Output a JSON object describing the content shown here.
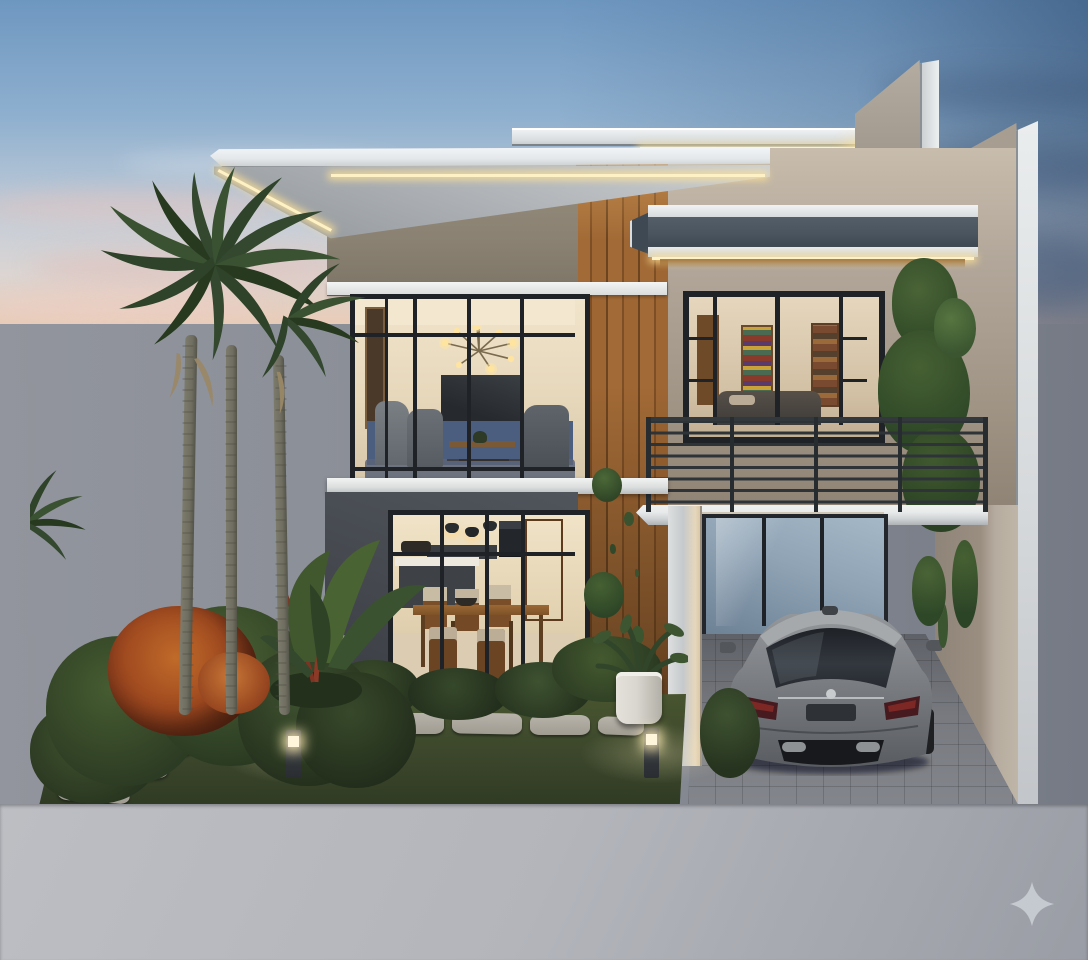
{
  "scene": {
    "description": "Dusk 3D architectural rendering of a modern two-storey house with white cantilevered LED-lit flat roofs, vertical wood slat accents, floor-to-ceiling black-framed glazing, a balcony with black bar railing, a carport with a parked grey sedan, palm trees and a landscaped front garden",
    "time_of_day": "dusk",
    "building": {
      "storeys": 2,
      "features": [
        "flat-roof-led-strip",
        "upper-roof",
        "stepped-parapet-fins",
        "wood-slat-feature-wall",
        "balcony-canopy",
        "balcony-bar-railing",
        "white-floor-slab",
        "charcoal-ground-wall",
        "carport-column"
      ],
      "living_room": [
        "sputnik-chandelier",
        "wall-tv",
        "navy-accent-wall",
        "armchairs",
        "wood-coffee-table",
        "area-rug"
      ],
      "bedroom": [
        "french-doors",
        "bookshelf",
        "bed",
        "wardrobe"
      ],
      "kitchen_dining": [
        "pendant-lights",
        "wall-oven",
        "kitchen-island",
        "wood-door",
        "wood-dining-table",
        "dining-chairs",
        "fruit-bowl"
      ]
    },
    "carport": [
      "grey-sedan-rear-view",
      "paver-floor",
      "reflective-back-window",
      "hanging-vines"
    ],
    "garden": [
      "palm-trees-3",
      "croton-red-shrub",
      "banana-plant",
      "green-bushes",
      "lawn",
      "stepping-stone-path",
      "stone-stair",
      "bollard-path-lights-2",
      "white-planter-pot",
      "climbing-vines"
    ],
    "background": [
      "sunset-sky",
      "pink-horizon-clouds",
      "dark-blue-cloud-bands",
      "grey-boundary-wall",
      "grey-concrete-foreground"
    ],
    "watermark": {
      "icon": "sparkle-icon"
    }
  },
  "colors": {
    "sky-top": "#6E97C0",
    "sky-mid": "#8FB0CF",
    "sky-low": "#C6CED8",
    "sunset-pink": "#E8CDBA",
    "bg-wall": "#8A8E97",
    "bg-wall-dark": "#757A85",
    "fg-ground": "#B3B5BB",
    "fg-ground-dark": "#9A9DA5",
    "roof-white": "#EDEFF1",
    "roof-soffit": "#A9ADB1",
    "led": "#FFF1C6",
    "wall-beige": "#8A8172",
    "wood": "#9E6633",
    "wood-dark": "#6B4420",
    "wall-cream": "#B2A79A",
    "wall-cream-dark": "#8F8478",
    "canopy-dark": "#4A545E",
    "wall-charcoal": "#45494F",
    "frame": "#1F2328",
    "glass-warm": "#E7D8BC",
    "glass-cool": "#8FA3B5",
    "navy": "#4C5E80",
    "rail": "#2E3338",
    "slab-white": "#E9EBEB",
    "grass": "#3C472C",
    "bush": "#2C3B23",
    "bush-light": "#4A5E33",
    "croton": "#A04A20",
    "croton-orange": "#C06A2A",
    "palm-green": "#33482E",
    "palm-trunk": "#6F6E60",
    "dried-frond": "#9A8867",
    "stone": "#B7B3AA",
    "paver": "#77797F",
    "car-body": "#7E8184",
    "car-dark": "#55585C",
    "car-light": "#A3A6A9",
    "pot": "#D9D6CF",
    "vine": "#3D5530",
    "sparkle": "#C9CDD4"
  }
}
